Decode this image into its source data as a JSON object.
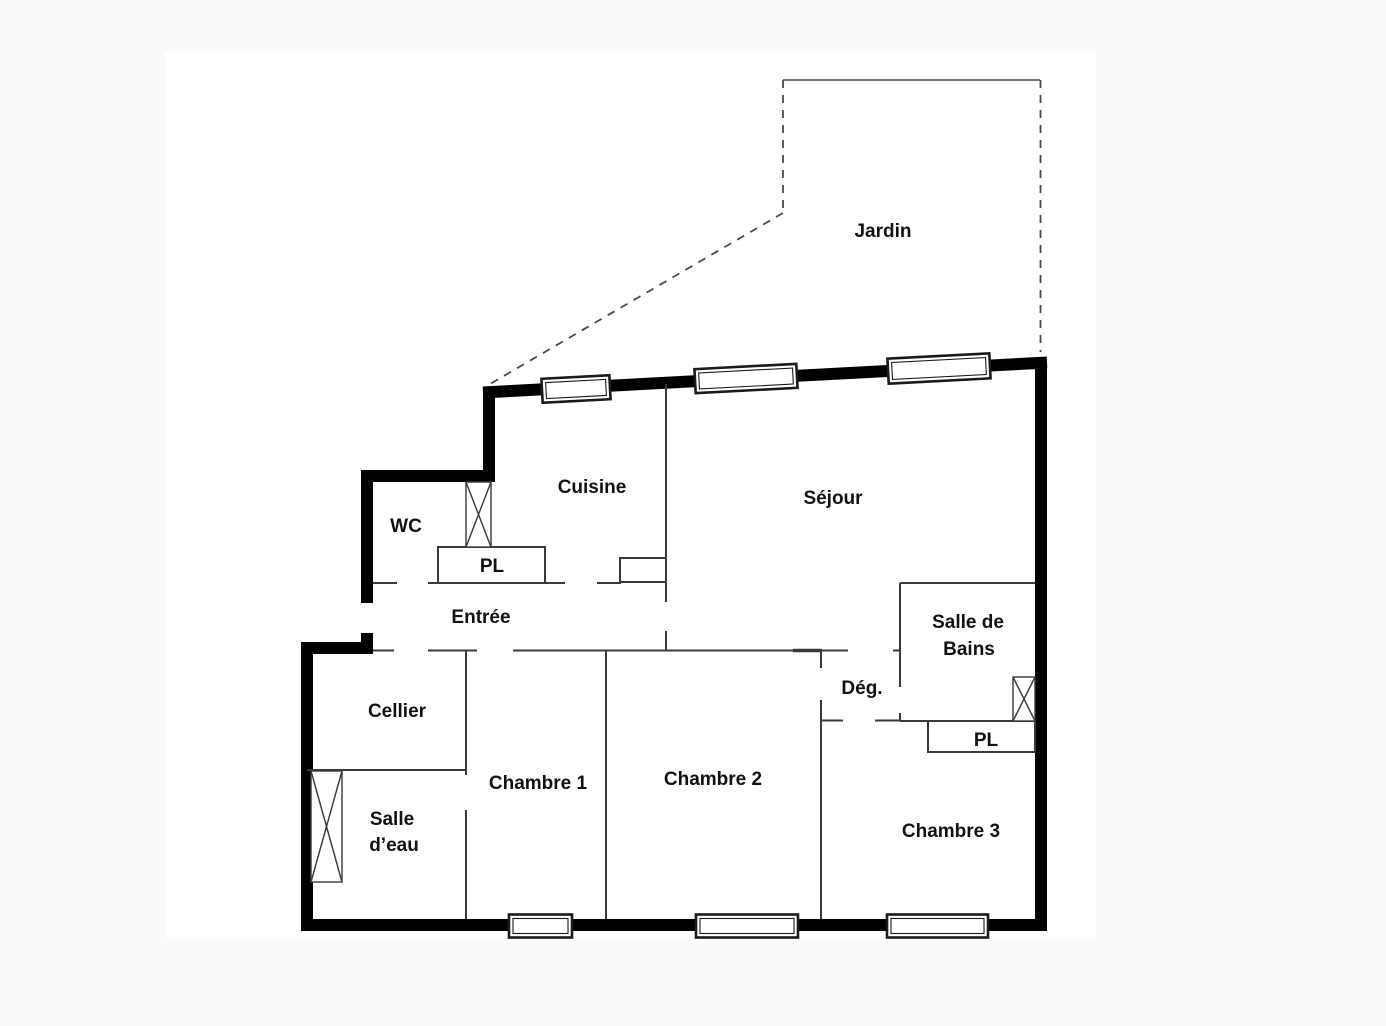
{
  "page": {
    "background": "#fafafa",
    "canvas_background": "#ffffff"
  },
  "colors": {
    "exterior_wall": "#000000",
    "interior_wall": "#3a3a3a",
    "boundary_dash": "#4a4a4a",
    "label_text": "#111111"
  },
  "floor_plan": {
    "rooms": {
      "jardin": {
        "label": "Jardin"
      },
      "cuisine": {
        "label": "Cuisine"
      },
      "sejour": {
        "label": "Séjour"
      },
      "wc": {
        "label": "WC"
      },
      "entree": {
        "label": "Entrée"
      },
      "entree_placard": {
        "label": "PL"
      },
      "salle_de_bains": {
        "label_line_1": "Salle de",
        "label_line_2": "Bains"
      },
      "degagement": {
        "label": "Dég."
      },
      "cellier": {
        "label": "Cellier"
      },
      "salle_eau": {
        "label_line_1": "Salle",
        "label_line_2": "d’eau"
      },
      "chambre_1": {
        "label": "Chambre 1"
      },
      "chambre_2": {
        "label": "Chambre 2"
      },
      "chambre_3": {
        "label": "Chambre 3"
      },
      "chambre_3_placard": {
        "label": "PL"
      }
    }
  }
}
